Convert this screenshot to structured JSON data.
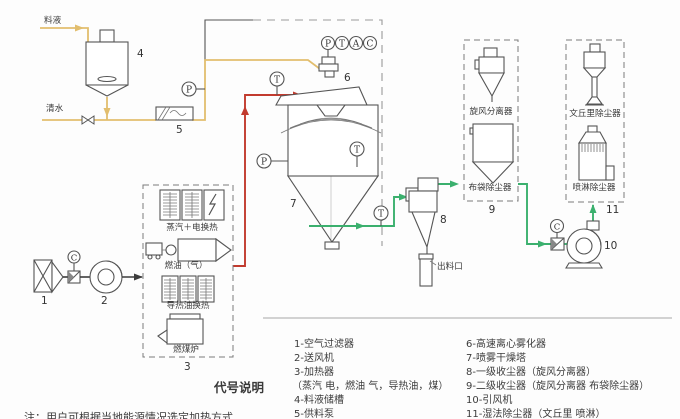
{
  "stream_labels": {
    "feed": "料液",
    "water": "清水",
    "discharge": "出料口"
  },
  "equipment_numbers": {
    "e1": "1",
    "e2": "2",
    "e3": "3",
    "e4": "4",
    "e5": "5",
    "e6": "6",
    "e7": "7",
    "e8": "8",
    "e9": "9",
    "e10": "10",
    "e11": "11"
  },
  "gauges": {
    "p": "P",
    "t": "T",
    "a": "A",
    "c": "C"
  },
  "heater_labels": {
    "steam_electric": "蒸汽＋电换热",
    "oil_gas": "燃油（气）",
    "thermal_oil": "导热油换热",
    "coal_furnace": "燃煤炉"
  },
  "collector_labels": {
    "cyclone": "旋风分离器",
    "bag": "布袋除尘器",
    "venturi": "文丘里除尘器",
    "spray": "喷淋除尘器"
  },
  "legend": {
    "heading": "代号说明",
    "left": [
      "1-空气过滤器",
      "2-送风机",
      "3-加热器",
      "（蒸汽 电，燃油 气，导热油，煤）",
      "4-料液储槽",
      "5-供料泵"
    ],
    "right": [
      "6-高速离心雾化器",
      "7-喷雾干燥塔",
      "8-一级收尘器（旋风分离器）",
      "9-二级收尘器（旋风分离器 布袋除尘器）",
      "10-引风机",
      "11-湿法除尘器（文丘里 喷淋）"
    ]
  },
  "note": "注：用户可根据当地能源情况选定加热方式",
  "colors": {
    "feed_line": "#e2be6e",
    "hot_air_line": "#c23b2e",
    "exhaust_line": "#3bb06e",
    "air_line": "#3c3c3c"
  }
}
